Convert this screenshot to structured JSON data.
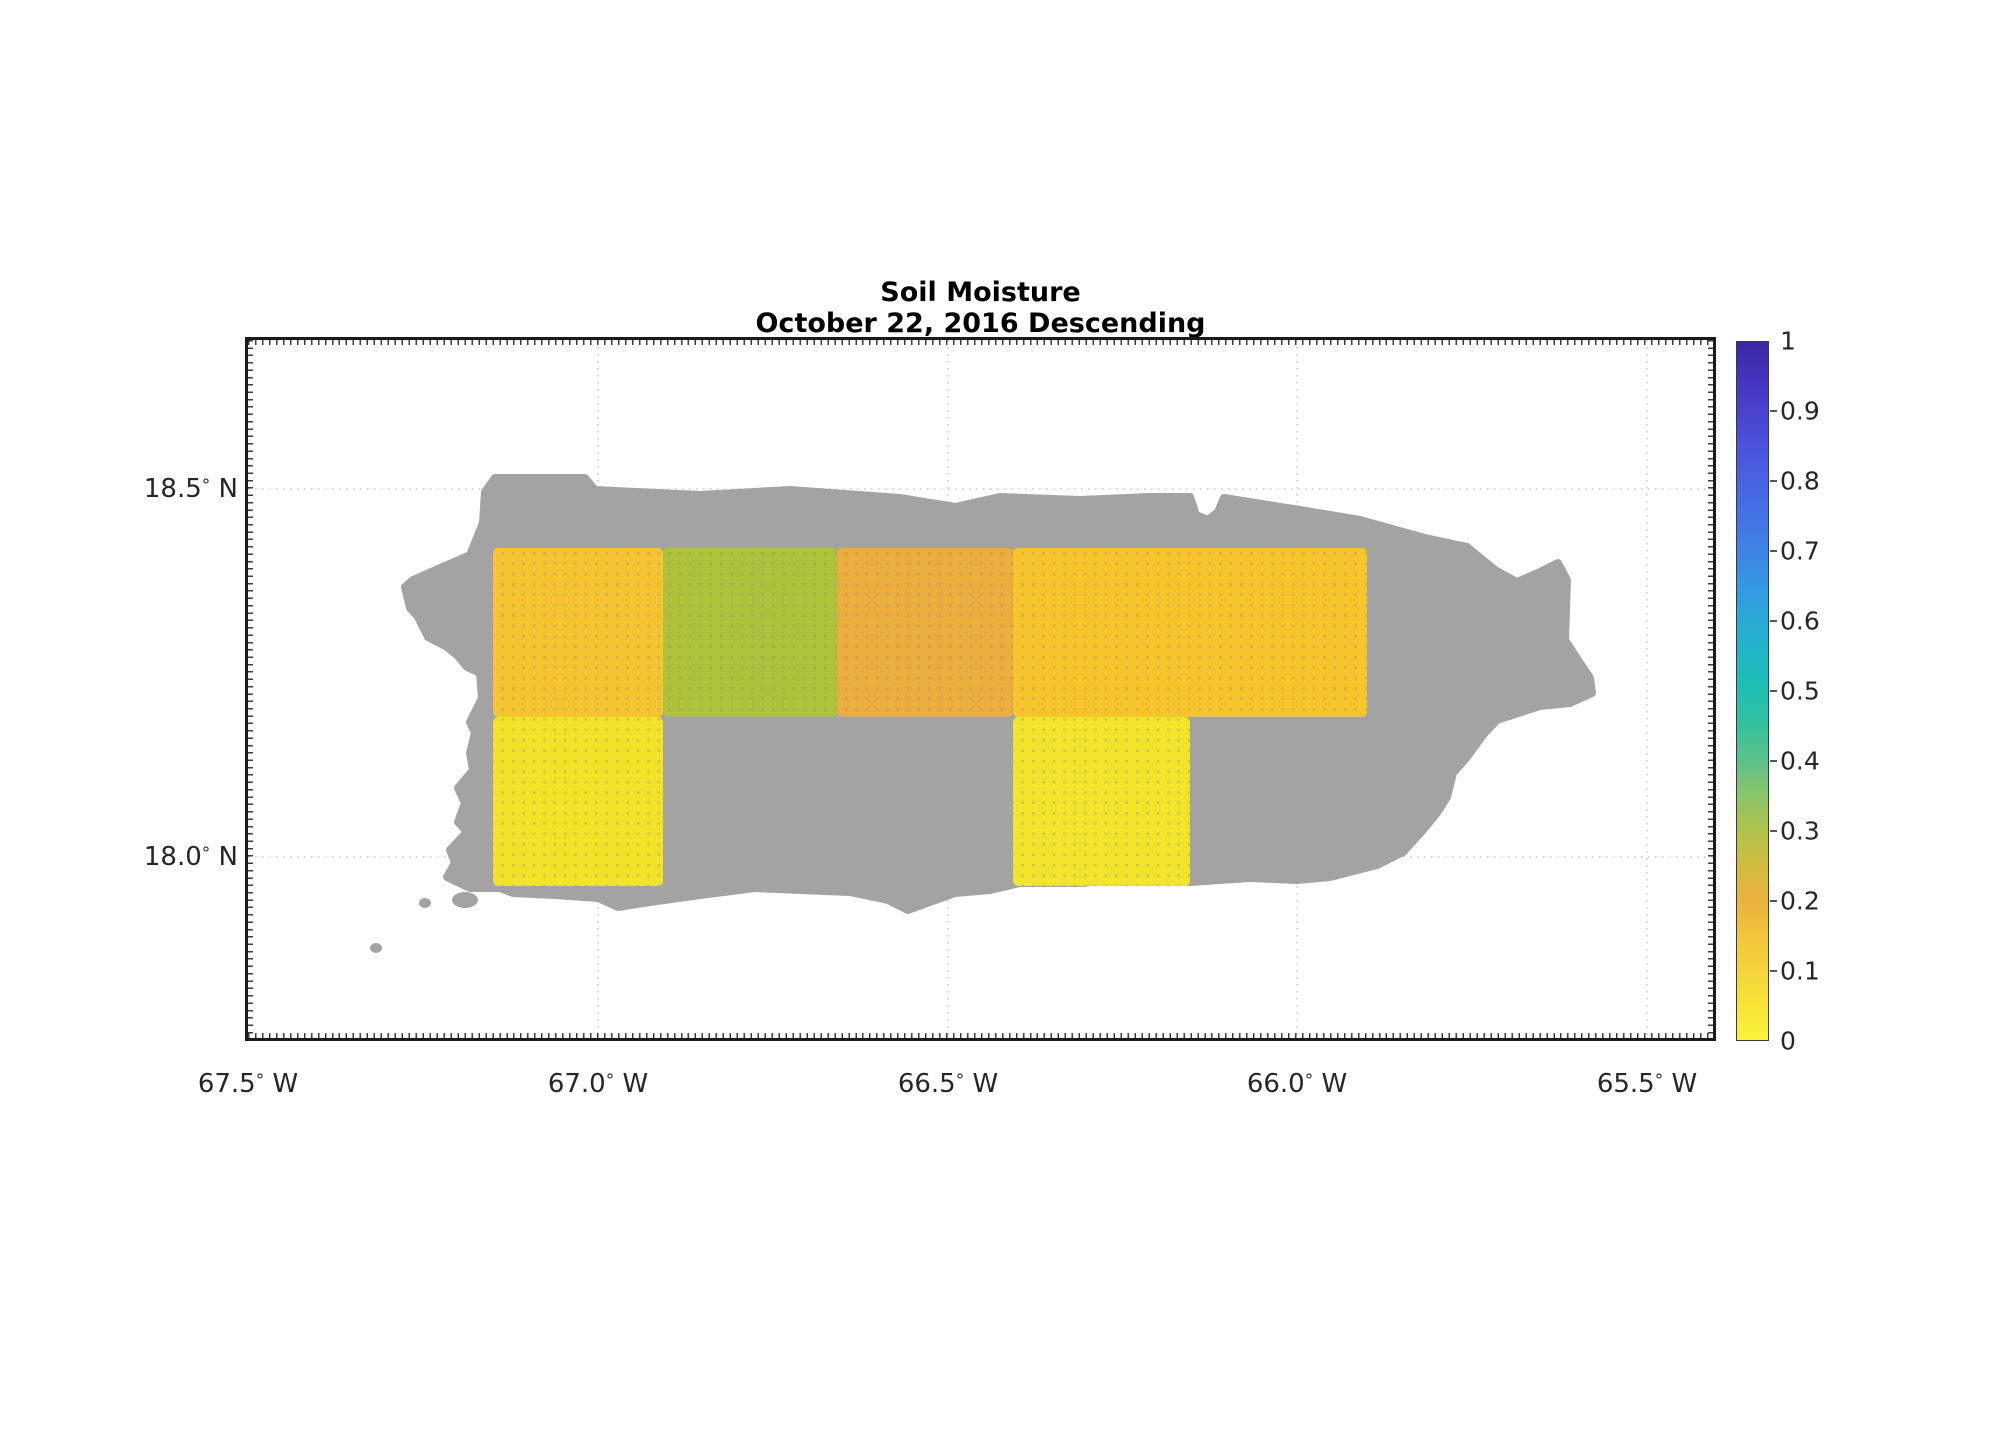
{
  "page": {
    "title_line1": "Soil Moisture",
    "title_line2": "October 22, 2016 Descending"
  },
  "chart_data": {
    "type": "heatmap",
    "title": "Soil Moisture",
    "subtitle": "October 22, 2016 Descending",
    "region": "Puerto Rico coastline (gray land mask) with gridded soil-moisture cells",
    "land_color": "#A3A3A3",
    "grid": {
      "on": true,
      "style": "dotted",
      "color": "#cbcbcb"
    },
    "x_axis": {
      "unit": "degrees longitude West",
      "range_lon": [
        -67.5,
        -65.4
      ],
      "ticks": [
        {
          "label": "67.5° W",
          "lon": -67.5,
          "px": 0
        },
        {
          "label": "67.0° W",
          "lon": -67.0,
          "px": 350
        },
        {
          "label": "66.5° W",
          "lon": -66.5,
          "px": 700
        },
        {
          "label": "66.0° W",
          "lon": -66.0,
          "px": 1049
        },
        {
          "label": "65.5° W",
          "lon": -65.5,
          "px": 1399
        }
      ]
    },
    "y_axis": {
      "unit": "degrees latitude North",
      "range_lat": [
        17.75,
        18.7
      ],
      "ticks": [
        {
          "label": "18.5° N",
          "lat": 18.5,
          "px": 149
        },
        {
          "label": "18.0° N",
          "lat": 18.0,
          "px": 517
        }
      ]
    },
    "cells": [
      {
        "lon_min": -67.15,
        "lon_max": -66.91,
        "lat_min": 18.19,
        "lat_max": 18.42,
        "value": 0.13,
        "color": "#F7C431",
        "x": 245,
        "y": 208,
        "w": 170,
        "h": 169
      },
      {
        "lon_min": -66.91,
        "lon_max": -66.66,
        "lat_min": 18.19,
        "lat_max": 18.42,
        "value": 0.31,
        "color": "#AFC23B",
        "x": 415,
        "y": 208,
        "w": 174,
        "h": 169
      },
      {
        "lon_min": -66.66,
        "lon_max": -66.4,
        "lat_min": 18.19,
        "lat_max": 18.42,
        "value": 0.2,
        "color": "#EBAD3D",
        "x": 589,
        "y": 208,
        "w": 176,
        "h": 169
      },
      {
        "lon_min": -66.4,
        "lon_max": -65.9,
        "lat_min": 18.19,
        "lat_max": 18.42,
        "value": 0.13,
        "color": "#F8C42C",
        "x": 765,
        "y": 208,
        "w": 354,
        "h": 169
      },
      {
        "lon_min": -67.15,
        "lon_max": -66.91,
        "lat_min": 17.96,
        "lat_max": 18.19,
        "value": 0.05,
        "color": "#F4E228",
        "x": 245,
        "y": 377,
        "w": 170,
        "h": 169
      },
      {
        "lon_min": -66.4,
        "lon_max": -66.15,
        "lat_min": 17.96,
        "lat_max": 18.19,
        "value": 0.05,
        "color": "#F2E42B",
        "x": 765,
        "y": 377,
        "w": 177,
        "h": 169
      }
    ],
    "colorbar": {
      "min": 0,
      "max": 1,
      "tick_labels": [
        "1",
        "0.9",
        "0.8",
        "0.7",
        "0.6",
        "0.5",
        "0.4",
        "0.3",
        "0.2",
        "0.1",
        "0"
      ],
      "stops": [
        {
          "v": 0.0,
          "c": "#FAF33B"
        },
        {
          "v": 0.05,
          "c": "#F8E437"
        },
        {
          "v": 0.1,
          "c": "#F4D43B"
        },
        {
          "v": 0.15,
          "c": "#F2C43C"
        },
        {
          "v": 0.2,
          "c": "#EBB23E"
        },
        {
          "v": 0.25,
          "c": "#D0BC40"
        },
        {
          "v": 0.3,
          "c": "#AFC24B"
        },
        {
          "v": 0.35,
          "c": "#8AC46A"
        },
        {
          "v": 0.4,
          "c": "#5CC28B"
        },
        {
          "v": 0.45,
          "c": "#35C19C"
        },
        {
          "v": 0.5,
          "c": "#1FBFB2"
        },
        {
          "v": 0.55,
          "c": "#1FB6C5"
        },
        {
          "v": 0.6,
          "c": "#2AA9D6"
        },
        {
          "v": 0.65,
          "c": "#3697E3"
        },
        {
          "v": 0.7,
          "c": "#3E84E5"
        },
        {
          "v": 0.75,
          "c": "#4373E5"
        },
        {
          "v": 0.8,
          "c": "#4763E2"
        },
        {
          "v": 0.85,
          "c": "#4B53DC"
        },
        {
          "v": 0.9,
          "c": "#4A43D0"
        },
        {
          "v": 0.95,
          "c": "#4433BE"
        },
        {
          "v": 1.0,
          "c": "#3B27A1"
        }
      ]
    },
    "island_outline_px": [
      [
        237,
        152
      ],
      [
        247,
        138
      ],
      [
        337,
        138
      ],
      [
        347,
        150
      ],
      [
        452,
        155
      ],
      [
        542,
        150
      ],
      [
        652,
        158
      ],
      [
        707,
        167
      ],
      [
        752,
        157
      ],
      [
        832,
        160
      ],
      [
        902,
        157
      ],
      [
        942,
        157
      ],
      [
        948,
        175
      ],
      [
        960,
        180
      ],
      [
        970,
        172
      ],
      [
        976,
        158
      ],
      [
        1052,
        170
      ],
      [
        1112,
        180
      ],
      [
        1177,
        198
      ],
      [
        1219,
        207
      ],
      [
        1247,
        230
      ],
      [
        1269,
        242
      ],
      [
        1292,
        232
      ],
      [
        1310,
        223
      ],
      [
        1319,
        240
      ],
      [
        1317,
        300
      ],
      [
        1330,
        320
      ],
      [
        1342,
        338
      ],
      [
        1344,
        353
      ],
      [
        1322,
        363
      ],
      [
        1292,
        366
      ],
      [
        1249,
        380
      ],
      [
        1235,
        395
      ],
      [
        1219,
        417
      ],
      [
        1205,
        433
      ],
      [
        1199,
        457
      ],
      [
        1189,
        473
      ],
      [
        1175,
        490
      ],
      [
        1155,
        512
      ],
      [
        1129,
        525
      ],
      [
        1082,
        537
      ],
      [
        1049,
        540
      ],
      [
        1002,
        538
      ],
      [
        942,
        542
      ],
      [
        892,
        538
      ],
      [
        832,
        543
      ],
      [
        772,
        543
      ],
      [
        742,
        550
      ],
      [
        707,
        553
      ],
      [
        682,
        562
      ],
      [
        660,
        570
      ],
      [
        640,
        560
      ],
      [
        602,
        552
      ],
      [
        552,
        550
      ],
      [
        507,
        548
      ],
      [
        452,
        555
      ],
      [
        402,
        562
      ],
      [
        370,
        567
      ],
      [
        350,
        558
      ],
      [
        307,
        555
      ],
      [
        265,
        553
      ],
      [
        252,
        548
      ],
      [
        222,
        548
      ],
      [
        199,
        537
      ],
      [
        207,
        523
      ],
      [
        202,
        510
      ],
      [
        219,
        492
      ],
      [
        210,
        482
      ],
      [
        217,
        463
      ],
      [
        210,
        448
      ],
      [
        225,
        430
      ],
      [
        222,
        413
      ],
      [
        227,
        393
      ],
      [
        222,
        382
      ],
      [
        234,
        358
      ],
      [
        232,
        333
      ],
      [
        219,
        327
      ],
      [
        209,
        315
      ],
      [
        199,
        307
      ],
      [
        180,
        297
      ],
      [
        170,
        277
      ],
      [
        162,
        268
      ],
      [
        157,
        247
      ],
      [
        165,
        240
      ],
      [
        199,
        225
      ],
      [
        222,
        215
      ],
      [
        235,
        183
      ]
    ],
    "islets_px": [
      {
        "cx": 217,
        "cy": 560,
        "rx": 13,
        "ry": 8
      },
      {
        "cx": 177,
        "cy": 563,
        "rx": 6,
        "ry": 5
      },
      {
        "cx": 128,
        "cy": 608,
        "rx": 6,
        "ry": 5
      }
    ]
  }
}
